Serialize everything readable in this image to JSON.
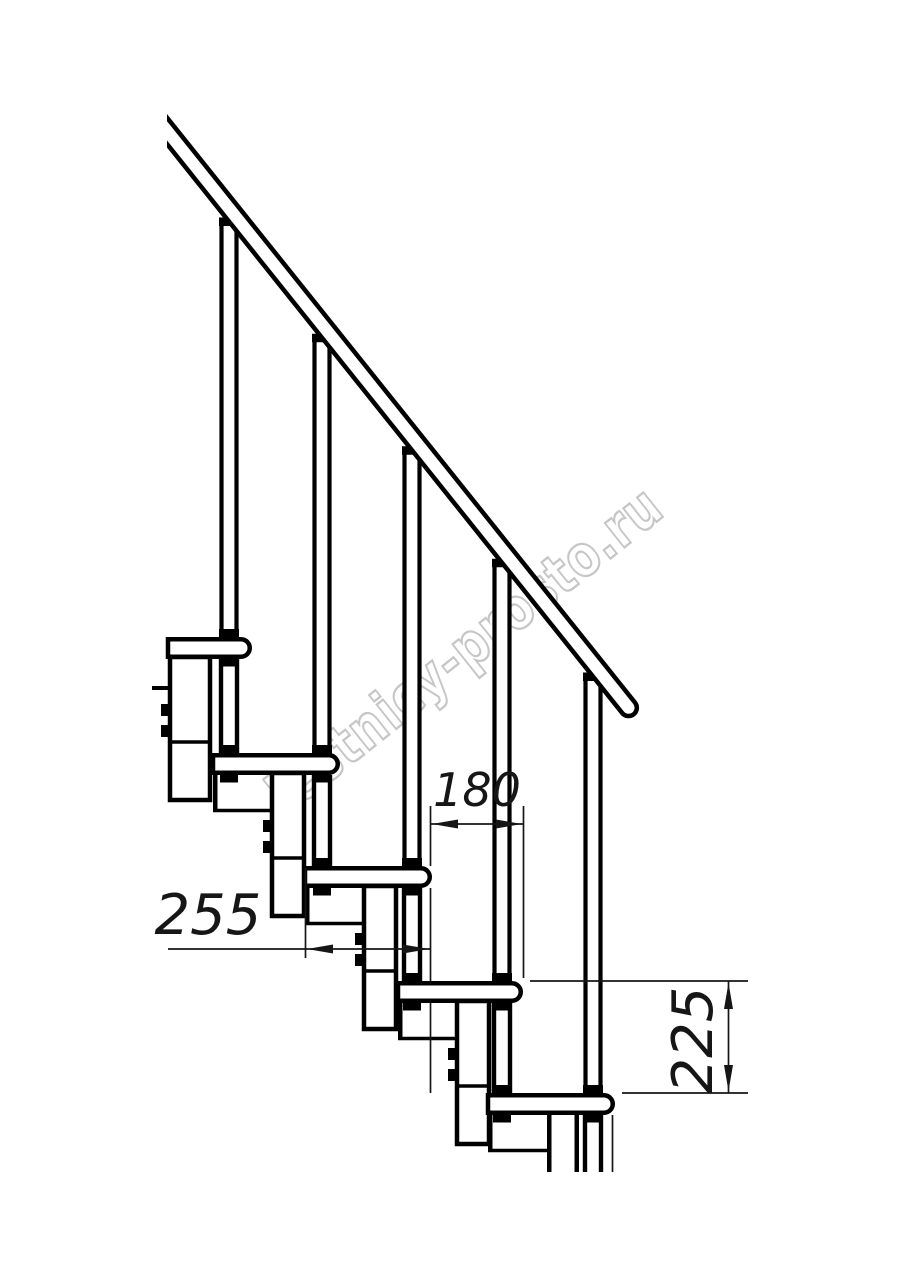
{
  "figure": {
    "kind": "technical-drawing",
    "subject": "Modular staircase side view with handrail, balusters, treads and support modules"
  },
  "watermark": {
    "text": "lestnicy-prosto.ru",
    "color": "#c6c6c6",
    "angle_deg": -38.5
  },
  "dimensions": [
    {
      "id": "tread-depth",
      "text": "255",
      "orientation": "horizontal"
    },
    {
      "id": "step-run",
      "text": "180",
      "orientation": "horizontal"
    },
    {
      "id": "step-rise",
      "text": "225",
      "orientation": "vertical"
    }
  ],
  "colors": {
    "background": "#ffffff",
    "line": "#000000",
    "dimension": "#161616"
  },
  "geometry": {
    "canvas": {
      "w": 914,
      "h": 1280
    },
    "tread_height": 22,
    "cut_bottom_y": 1172,
    "rail": {
      "x": 167,
      "y": 114,
      "length": 752,
      "band": 21,
      "angle_deg": 51.34
    },
    "steps": [
      {
        "left": 168,
        "nose": 252,
        "top": 637,
        "baluster_cx": 229
      },
      {
        "left": 213,
        "nose": 340,
        "top": 753,
        "baluster_cx": 322
      },
      {
        "left": 305,
        "nose": 432,
        "top": 866,
        "baluster_cx": 412
      },
      {
        "left": 398,
        "nose": 523,
        "top": 981,
        "baluster_cx": 502
      },
      {
        "left": 488,
        "nose": 615,
        "top": 1093,
        "baluster_cx": 593
      }
    ]
  }
}
